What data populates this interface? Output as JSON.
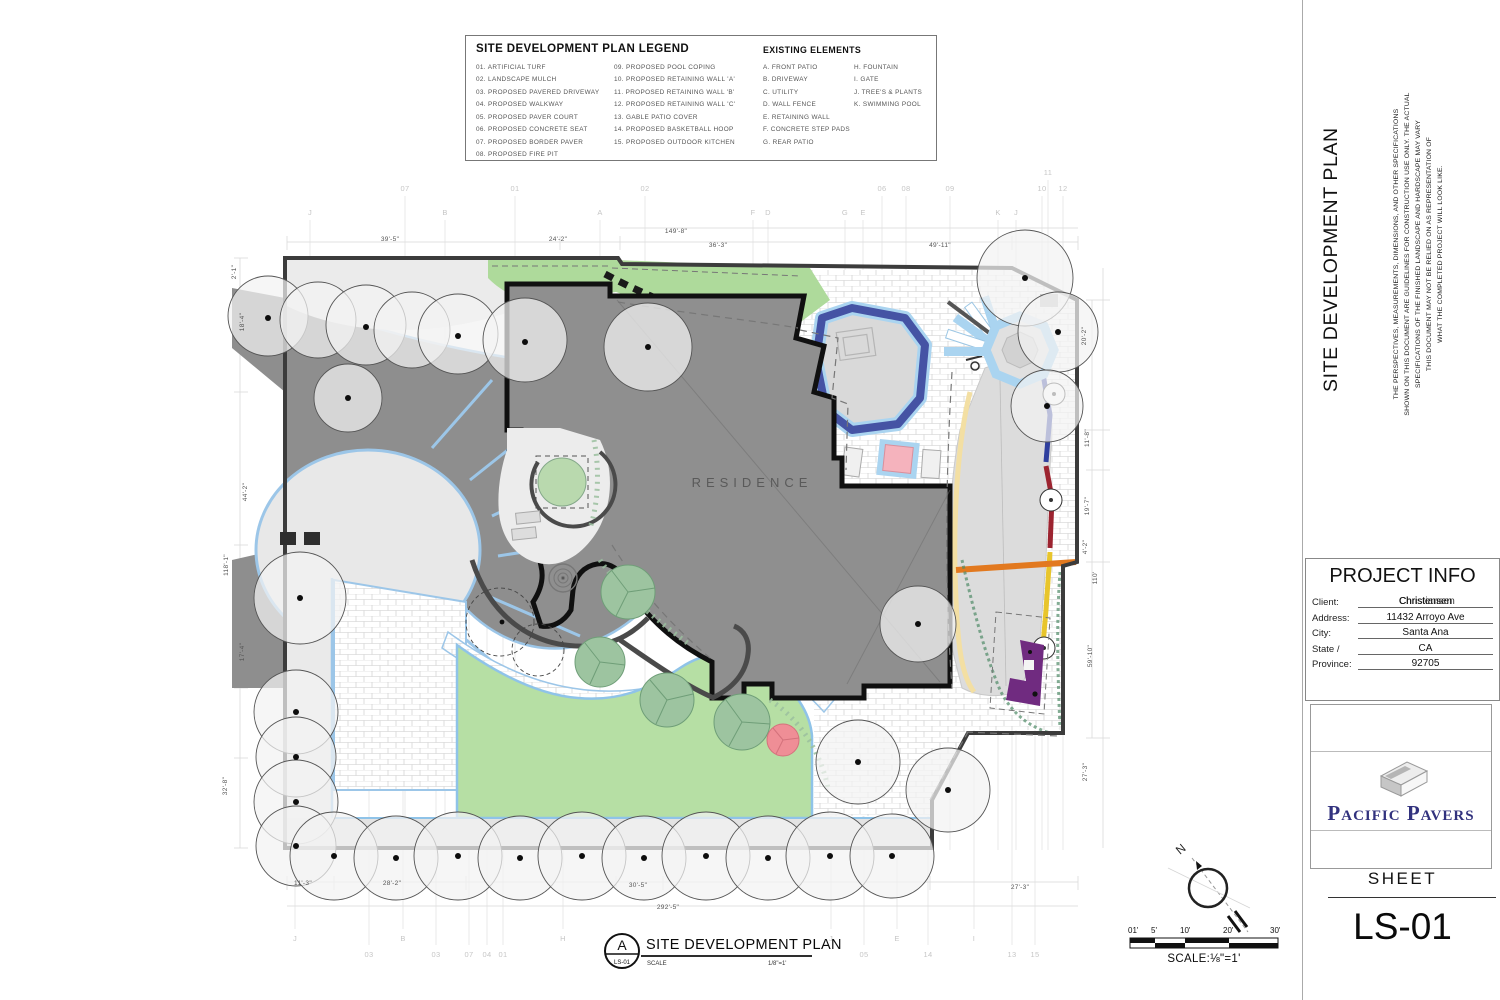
{
  "legend": {
    "title": "SITE DEVELOPMENT PLAN LEGEND",
    "items_col1": [
      "01.  ARTIFICIAL TURF",
      "02.  LANDSCAPE MULCH",
      "03.  PROPOSED PAVERED DRIVEWAY",
      "04.  PROPOSED WALKWAY",
      "05.  PROPOSED PAVER COURT",
      "06.  PROPOSED CONCRETE SEAT",
      "07.  PROPOSED BORDER PAVER",
      "08.  PROPOSED FIRE PIT"
    ],
    "items_col2": [
      "09.  PROPOSED POOL COPING",
      "10.  PROPOSED RETAINING WALL 'A'",
      "11.  PROPOSED RETAINING WALL 'B'",
      "12.  PROPOSED RETAINING WALL 'C'",
      "13.  GABLE PATIO COVER",
      "14.  PROPOSED BASKETBALL HOOP",
      "15.  PROPOSED OUTDOOR KITCHEN"
    ],
    "existing_title": "EXISTING ELEMENTS",
    "existing_col1": [
      "A.  FRONT PATIO",
      "B.  DRIVEWAY",
      "C.  UTILITY",
      "D.  WALL FENCE",
      "E.  RETAINING WALL",
      "F.  CONCRETE STEP PADS",
      "G.  REAR PATIO"
    ],
    "existing_col2": [
      "H.  FOUNTAIN",
      "I.  GATE",
      "J.  TREE'S & PLANTS",
      "K.  SWIMMING POOL"
    ]
  },
  "plan": {
    "residence_label": "RESIDENCE",
    "dim_labels": [
      {
        "t": "39'-5\"",
        "x": 390,
        "y": 241
      },
      {
        "t": "24'-2\"",
        "x": 558,
        "y": 241
      },
      {
        "t": "149'-8\"",
        "x": 676,
        "y": 233
      },
      {
        "t": "36'-3\"",
        "x": 718,
        "y": 247
      },
      {
        "t": "49'-11\"",
        "x": 940,
        "y": 247
      },
      {
        "t": "2'-1\"",
        "x": 236,
        "y": 272,
        "r": -90
      },
      {
        "t": "18'-4\"",
        "x": 244,
        "y": 322,
        "r": -90
      },
      {
        "t": "44'-2\"",
        "x": 247,
        "y": 492,
        "r": -90
      },
      {
        "t": "118'-1\"",
        "x": 228,
        "y": 565,
        "r": -90
      },
      {
        "t": "17'-4\"",
        "x": 244,
        "y": 652,
        "r": -90
      },
      {
        "t": "32'-8\"",
        "x": 227,
        "y": 786,
        "r": -90
      },
      {
        "t": "20'-2\"",
        "x": 1086,
        "y": 336,
        "r": -90
      },
      {
        "t": "11'-8\"",
        "x": 1089,
        "y": 438,
        "r": -90
      },
      {
        "t": "19'-7\"",
        "x": 1089,
        "y": 506,
        "r": -90
      },
      {
        "t": "4'-2\"",
        "x": 1087,
        "y": 547,
        "r": -90
      },
      {
        "t": "110'",
        "x": 1097,
        "y": 578,
        "r": -90
      },
      {
        "t": "59'-10\"",
        "x": 1092,
        "y": 656,
        "r": -90
      },
      {
        "t": "27'-3\"",
        "x": 1087,
        "y": 772,
        "r": -90
      },
      {
        "t": "11'-3\"",
        "x": 303,
        "y": 885
      },
      {
        "t": "28'-2\"",
        "x": 392,
        "y": 885
      },
      {
        "t": "30'-5\"",
        "x": 638,
        "y": 887
      },
      {
        "t": "292'-5\"",
        "x": 668,
        "y": 909
      },
      {
        "t": "27'-3\"",
        "x": 1020,
        "y": 889
      }
    ],
    "grid_labels": [
      {
        "t": "J",
        "x": 310,
        "y": 215
      },
      {
        "t": "07",
        "x": 405,
        "y": 191
      },
      {
        "t": "B",
        "x": 445,
        "y": 215
      },
      {
        "t": "01",
        "x": 515,
        "y": 191
      },
      {
        "t": "A",
        "x": 600,
        "y": 215
      },
      {
        "t": "02",
        "x": 645,
        "y": 191
      },
      {
        "t": "F",
        "x": 753,
        "y": 215
      },
      {
        "t": "D",
        "x": 768,
        "y": 215
      },
      {
        "t": "G",
        "x": 845,
        "y": 215
      },
      {
        "t": "E",
        "x": 863,
        "y": 215
      },
      {
        "t": "06",
        "x": 882,
        "y": 191
      },
      {
        "t": "08",
        "x": 906,
        "y": 191
      },
      {
        "t": "09",
        "x": 950,
        "y": 191
      },
      {
        "t": "K",
        "x": 998,
        "y": 215
      },
      {
        "t": "J",
        "x": 1016,
        "y": 215
      },
      {
        "t": "11",
        "x": 1048,
        "y": 175
      },
      {
        "t": "10",
        "x": 1042,
        "y": 191
      },
      {
        "t": "12",
        "x": 1063,
        "y": 191
      },
      {
        "t": "J",
        "x": 295,
        "y": 941
      },
      {
        "t": "B",
        "x": 403,
        "y": 941
      },
      {
        "t": "H",
        "x": 563,
        "y": 941
      },
      {
        "t": "J",
        "x": 831,
        "y": 941
      },
      {
        "t": "E",
        "x": 897,
        "y": 941
      },
      {
        "t": "I",
        "x": 974,
        "y": 941
      },
      {
        "t": "03",
        "x": 369,
        "y": 957
      },
      {
        "t": "03",
        "x": 436,
        "y": 957
      },
      {
        "t": "07",
        "x": 469,
        "y": 957
      },
      {
        "t": "04",
        "x": 487,
        "y": 957
      },
      {
        "t": "01",
        "x": 503,
        "y": 957
      },
      {
        "t": "05",
        "x": 864,
        "y": 957
      },
      {
        "t": "14",
        "x": 928,
        "y": 957
      },
      {
        "t": "13",
        "x": 1012,
        "y": 957
      },
      {
        "t": "15",
        "x": 1035,
        "y": 957
      }
    ]
  },
  "title_block": {
    "detail_letter": "A",
    "detail_sheet": "LS-01",
    "title": "SITE DEVELOPMENT PLAN",
    "scale_label": "SCALE",
    "scale_value": "1/8\"=1'"
  },
  "north_scale": {
    "north_label": "N",
    "ticks": [
      "01'",
      "5'",
      "10'",
      "20'",
      "30'"
    ],
    "scale_text": "SCALE:⅛\"=1'"
  },
  "sidebar": {
    "vertical_title": "SITE DEVELOPMENT PLAN",
    "disclaimer_lines": [
      "THE PERSPECTIVES, MEASUREMENTS, DIMENSIONS, AND OTHER SPECIFICATIONS",
      "SHOWN ON THIS DOCUMENT ARE GUIDELINES FOR CONSTRUCTION USE ONLY. THE ACTUAL",
      "SPECIFICATIONS OF THE FINISHED LANDSCAPE AND HARDSCAPE MAY VARY",
      "THIS DOCUMENT MAY NOT BE RELIED ON AS REPRESENTATION OF",
      "WHAT THE COMPLETED PROJECT  WILL LOOK LIKE."
    ],
    "project_info": {
      "title": "PROJECT INFO",
      "client_label": "Client:",
      "client_value": "Christensen",
      "client_value_overlap": "Christiansen",
      "address_label": "Address:",
      "address_value": "11432 Arroyo Ave",
      "city_label": "City:",
      "city_value": "Santa Ana",
      "state_label": "State /",
      "state_value": "CA",
      "province_label": "Province:",
      "province_value": "92705"
    },
    "logo_text": "Pacific Pavers",
    "sheet_label": "SHEET",
    "sheet_number": "LS-01"
  }
}
